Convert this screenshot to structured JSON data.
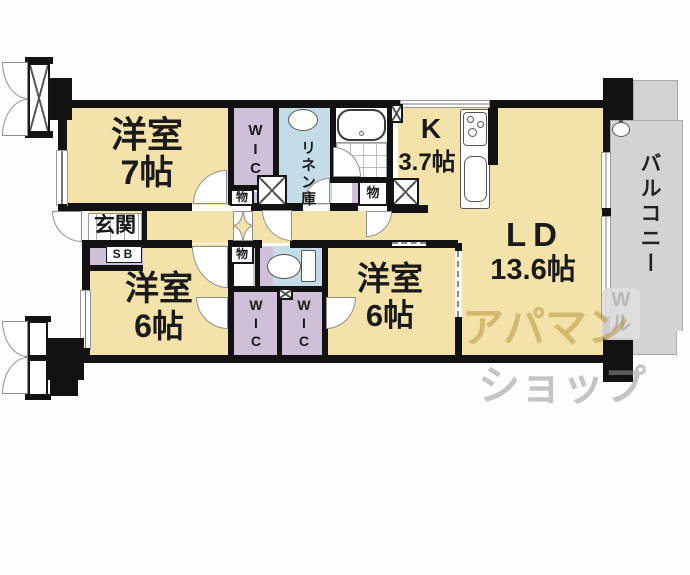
{
  "floorplan": {
    "rooms": {
      "bedroom_7": {
        "name": "洋室",
        "size": "7帖"
      },
      "bedroom_6_left": {
        "name": "洋室",
        "size": "6帖"
      },
      "bedroom_6_right": {
        "name": "洋室",
        "size": "6帖"
      },
      "kitchen": {
        "name": "K",
        "size": "3.7帖"
      },
      "living_dining": {
        "name": "LD",
        "size": "13.6帖"
      },
      "balcony": {
        "name": "バルコニー"
      },
      "entrance": {
        "name": "玄関"
      },
      "shoe_box": {
        "name": "SB"
      },
      "linen_closet": {
        "name": "リネン庫"
      },
      "walk_in_closet": {
        "name": "WIC"
      },
      "storage": {
        "name": "物"
      }
    },
    "watermark": {
      "brand_line1": "アパマン",
      "brand_line2": "ショップ",
      "badge_line1": "W",
      "badge_line2": "ル"
    },
    "colors": {
      "floor": "#F3E2AA",
      "closet": "#CEC0D8",
      "wet_area": "#C4DCE8",
      "balcony": "#D3D3D3",
      "wall": "#121212",
      "watermark_brand": "#B08A33",
      "watermark_gray": "#C8C8C8"
    }
  }
}
